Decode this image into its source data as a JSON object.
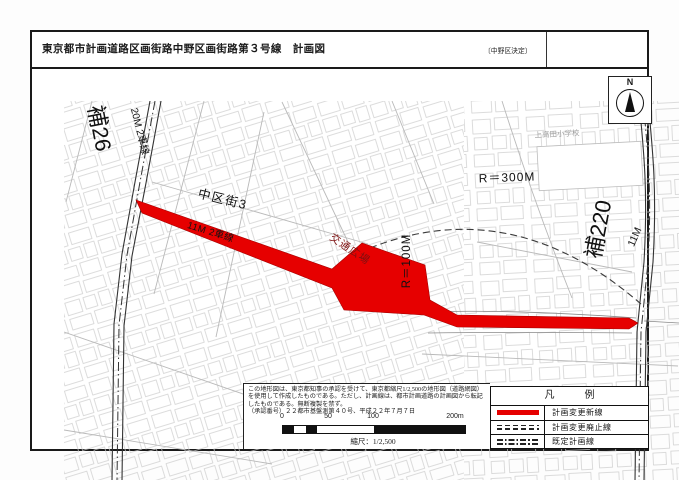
{
  "page": {
    "title": "東京都市計画道路区画街路中野区画街路第３号線　計画図",
    "decision_note": "〔中野区決定〕"
  },
  "map": {
    "labels": {
      "ho26": "補26",
      "lane20m": "20M 2車線",
      "nakakugai3": "中区街3",
      "lane11m": "11M 2車線",
      "plaza": "交通広場",
      "r100": "R＝100M",
      "r300": "R＝300M",
      "ho220": "補220",
      "w11m": "11M",
      "school": "上高田小学校",
      "north": "N"
    },
    "colors": {
      "plan_new_red": "#e60000",
      "existing_line_black": "#222222",
      "building_outline_gray": "#cccccc"
    }
  },
  "notes": {
    "lines": [
      "この地形図は、東京都知事の承認を受けて、東京都縮尺1/2,500の地形図（道路網図）",
      "を使用して作成したものである。ただし、計画線は、都市計画道路の計画図から転記",
      "したものである。無断複製を禁ず。",
      "（承認番号）２２都市基盤測第４０号、平成２２年７月７日"
    ]
  },
  "scalebar": {
    "ticks": [
      "0",
      "50",
      "100",
      "200m"
    ],
    "caption": "縮尺：1/2,500"
  },
  "legend": {
    "header": "凡　　　例",
    "items": [
      {
        "symbol": "solid-red",
        "label": "計画変更新線"
      },
      {
        "symbol": "dashed-black",
        "label": "計画変更廃止線"
      },
      {
        "symbol": "dashdot-black",
        "label": "既定計画線"
      }
    ]
  }
}
